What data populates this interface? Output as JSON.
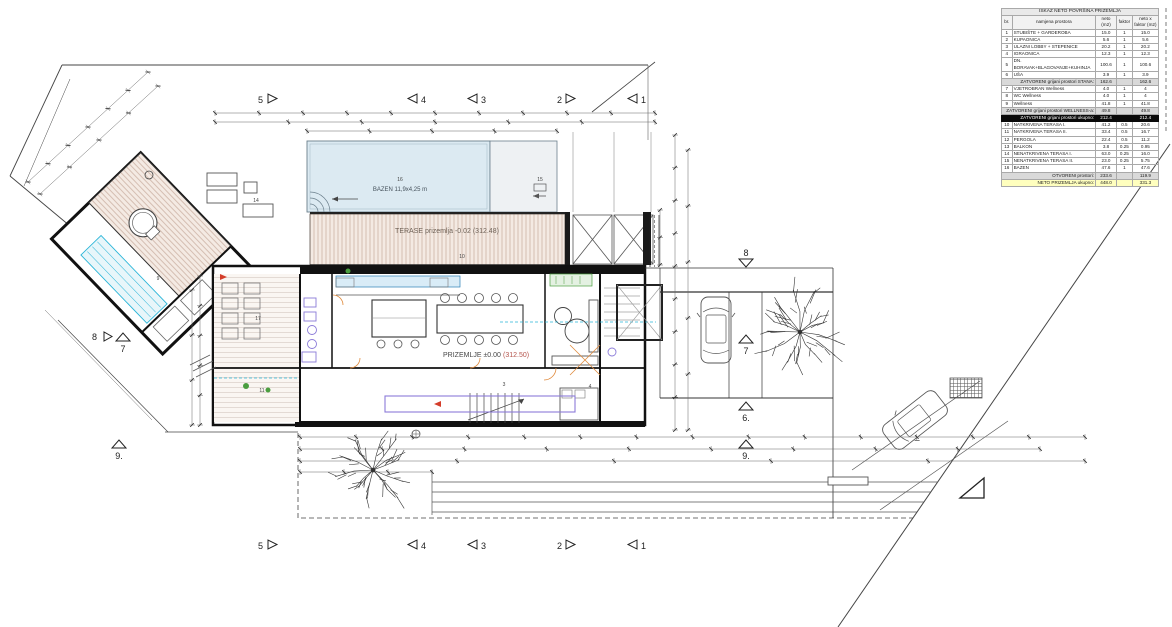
{
  "table": {
    "title": "ISKAZ NETO POVRŠINA PRIZEMLJA",
    "columns": [
      "br.",
      "namjena prostora",
      "neto (m2)",
      "faktor",
      "neto x faktor (m2)"
    ],
    "rows": [
      {
        "type": "item",
        "num": "1",
        "name": "STUBIŠTE + GARDEROBA",
        "neto": "15.0",
        "faktor": "1",
        "tot": "15.0"
      },
      {
        "type": "item",
        "num": "2",
        "name": "KUPAONICA",
        "neto": "5.6",
        "faktor": "1",
        "tot": "5.6"
      },
      {
        "type": "item",
        "num": "3",
        "name": "ULAZNI LOBBY + STEPENICE",
        "neto": "20.2",
        "faktor": "1",
        "tot": "20.2"
      },
      {
        "type": "item",
        "num": "4",
        "name": "IGRAONICA",
        "neto": "12.3",
        "faktor": "1",
        "tot": "12.3"
      },
      {
        "type": "item",
        "num": "5",
        "name": "DN. BORAVAK+BLAGOVANJE+KUHINJA",
        "neto": "100.6",
        "faktor": "1",
        "tot": "100.6"
      },
      {
        "type": "item",
        "num": "6",
        "name": "UŠA",
        "neto": "3.9",
        "faktor": "1",
        "tot": "3.9"
      },
      {
        "type": "sub",
        "name": "ZATVORENI grijani prostori STANA:",
        "neto": "162.6",
        "faktor": "",
        "tot": "162.6"
      },
      {
        "type": "item",
        "num": "7",
        "name": "VJETROBRAN Wellness",
        "neto": "4.0",
        "faktor": "1",
        "tot": "4"
      },
      {
        "type": "item",
        "num": "8",
        "name": "WC Wellness",
        "neto": "4.0",
        "faktor": "1",
        "tot": "4"
      },
      {
        "type": "item",
        "num": "9",
        "name": "Wellness",
        "neto": "41.8",
        "faktor": "1",
        "tot": "41.8"
      },
      {
        "type": "sub",
        "name": "ZATVORENI grijani prostori WELLNESS-a:",
        "neto": "49.8",
        "faktor": "",
        "tot": "49.8"
      },
      {
        "type": "black",
        "name": "ZATVORENI grijani prostori ukupno:",
        "neto": "212.4",
        "faktor": "",
        "tot": "212.4"
      },
      {
        "type": "item",
        "num": "10",
        "name": "NATKRIVENA TERASA I.",
        "neto": "41.2",
        "faktor": "0.5",
        "tot": "20.6"
      },
      {
        "type": "item",
        "num": "11",
        "name": "NATKRIVENA TERASA II.",
        "neto": "33.4",
        "faktor": "0.5",
        "tot": "16.7"
      },
      {
        "type": "item",
        "num": "12",
        "name": "PERGOLA",
        "neto": "22.4",
        "faktor": "0.5",
        "tot": "11.2"
      },
      {
        "type": "item",
        "num": "13",
        "name": "BALKON",
        "neto": "3.8",
        "faktor": "0.25",
        "tot": "0.95"
      },
      {
        "type": "item",
        "num": "14",
        "name": "NENATKRIVENA TERASA I.",
        "neto": "63.0",
        "faktor": "0.25",
        "tot": "16.0"
      },
      {
        "type": "item",
        "num": "15",
        "name": "NENATKRIVENA TERASA II.",
        "neto": "23.0",
        "faktor": "0.25",
        "tot": "5.75"
      },
      {
        "type": "item",
        "num": "16",
        "name": "BAZEN",
        "neto": "47.6",
        "faktor": "1",
        "tot": "47.6"
      },
      {
        "type": "sub",
        "name": "OTVORENI prostori:",
        "neto": "233.6",
        "faktor": "",
        "tot": "119.9"
      },
      {
        "type": "yellow",
        "name": "NETO PRIZEMLJA ukupno:",
        "neto": "448.0",
        "faktor": "",
        "tot": "331.3"
      }
    ]
  },
  "plan": {
    "labels": {
      "bazen": "BAZEN 11,9x4,25 m",
      "terase": "TERASE prizemlja -0.02 (312.48)",
      "prizemlje": "PRIZEMLJE ±0.00",
      "prizemlje_kota": "(312.50)"
    },
    "rooms": {
      "r3": "3",
      "r4": "4",
      "r9": "9",
      "r10": "10",
      "r11": "11",
      "r14": "14",
      "r15": "15",
      "r16": "16",
      "r17": "17"
    },
    "grid": {
      "top": [
        "5",
        "4",
        "3",
        "2",
        "1"
      ],
      "bottom": [
        "5",
        "4",
        "3",
        "2",
        "1"
      ],
      "right": [
        "8",
        "7",
        "6.",
        "9."
      ],
      "left": [
        "8",
        "7",
        "9."
      ]
    }
  },
  "colors": {
    "water": "#dceaf2",
    "terrace": "#f4eae3",
    "hatch": "#cdb3a6",
    "purple": "#8b7bd8",
    "cyan": "#2ab5d8",
    "green": "#4a9e3f",
    "orange": "#e08a3c",
    "red": "#d43d2a",
    "total_yellow": "#ffffbe"
  }
}
